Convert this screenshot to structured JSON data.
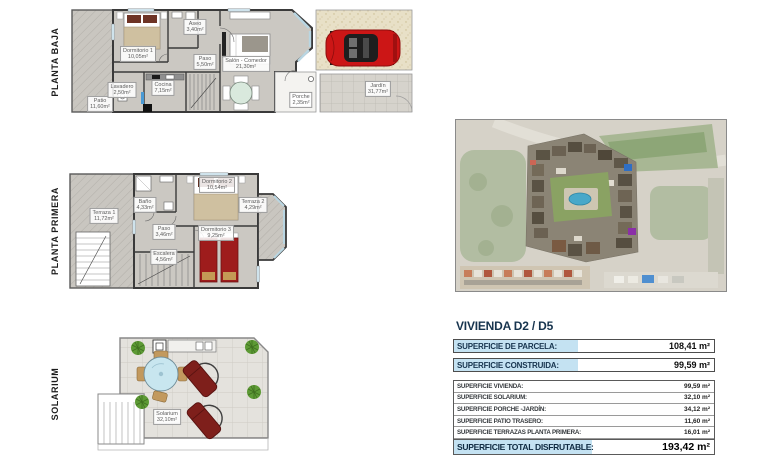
{
  "document": {
    "sheet_title": "VIVIENDA D2 / D5"
  },
  "plans": {
    "planta_baja": {
      "title": "PLANTA BAJA",
      "rooms": [
        {
          "name": "Patio",
          "area": "11,60m²"
        },
        {
          "name": "Dormitorio 1",
          "area": "10,05m²"
        },
        {
          "name": "Aseo",
          "area": "3,40m²"
        },
        {
          "name": "Paso",
          "area": "5,50m²"
        },
        {
          "name": "Salón - Comedor",
          "area": "21,30m²"
        },
        {
          "name": "Lavadero",
          "area": "2,50m²"
        },
        {
          "name": "Cocina",
          "area": "7,15m²"
        },
        {
          "name": "Porche",
          "area": "2,35m²"
        },
        {
          "name": "Jardín",
          "area": "31,77m²"
        }
      ]
    },
    "planta_primera": {
      "title": "PLANTA PRIMERA",
      "rooms": [
        {
          "name": "Terraza 1",
          "area": "11,72m²"
        },
        {
          "name": "Baño",
          "area": "4,33m²"
        },
        {
          "name": "Dormitorio 2",
          "area": "10,54m²"
        },
        {
          "name": "Terraza 2",
          "area": "4,29m²"
        },
        {
          "name": "Paso",
          "area": "3,46m²"
        },
        {
          "name": "Escalera",
          "area": "4,56m²"
        },
        {
          "name": "Dormitorio 3",
          "area": "9,25m²"
        }
      ]
    },
    "solarium": {
      "title": "SOLARIUM",
      "rooms": [
        {
          "name": "Solarium",
          "area": "32,10m²"
        }
      ]
    }
  },
  "summary": {
    "title": "VIVIENDA D2 / D5",
    "parcela": {
      "label": "SUPERFICIE DE PARCELA:",
      "value": "108,41 m²"
    },
    "construida": {
      "label": "SUPERFICIE CONSTRUIDA:",
      "value": "99,59 m²"
    },
    "rows": [
      {
        "label": "SUPERFICIE VIVIENDA:",
        "value": "99,59 m²"
      },
      {
        "label": "SUPERFICIE SOLARIUM:",
        "value": "32,10 m²"
      },
      {
        "label": "SUPERFICIE PORCHE -JARDÍN:",
        "value": "34,12 m²"
      },
      {
        "label": "SUPERFICIE PATIO TRASERO:",
        "value": "11,60 m²"
      },
      {
        "label": "SUPERFICIE TERRAZAS PLANTA PRIMERA:",
        "value": "16,01 m²"
      }
    ],
    "total": {
      "label": "SUPERFICIE TOTAL DISFRUTABLE:",
      "value": "193,42 m²"
    }
  },
  "colors": {
    "highlight_blue": "#c4e2f2",
    "title_navy": "#17344e",
    "car_red": "#cc1616",
    "bed_red": "#9e1c1c",
    "plan_floor_gray": "#cbc8c2",
    "pool_blue": "#49a8c9"
  }
}
